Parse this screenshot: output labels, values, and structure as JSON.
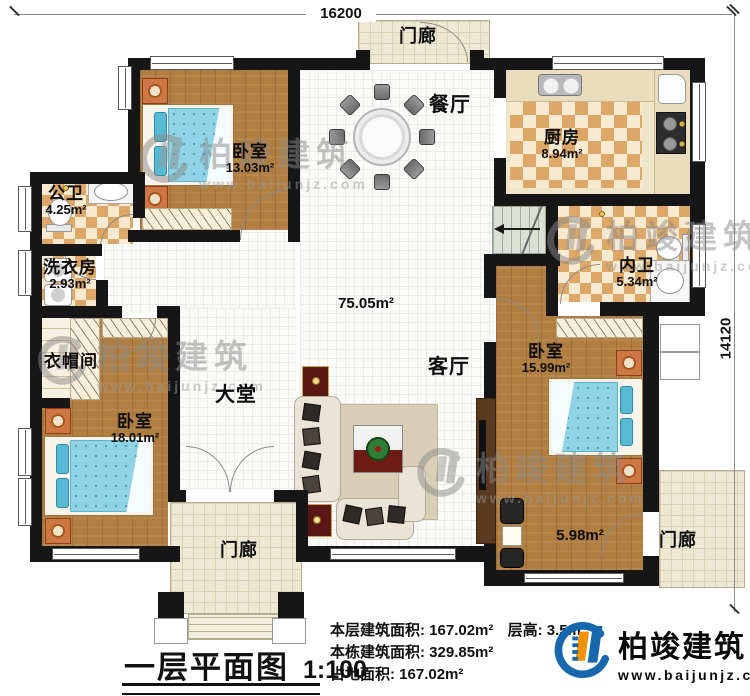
{
  "plan": {
    "dims": {
      "top": "16200",
      "right": "14120"
    },
    "rooms": {
      "bedroom_tl": {
        "name": "卧室",
        "area": "13.03m²"
      },
      "public_bath": {
        "name": "公卫",
        "area": "4.25m²"
      },
      "laundry": {
        "name": "洗衣房",
        "area": "2.93m²"
      },
      "cloakroom": {
        "name": "衣帽间",
        "area": ""
      },
      "bedroom_bl": {
        "name": "卧室",
        "area": "18.01m²"
      },
      "hall": {
        "name": "大堂",
        "area": ""
      },
      "living": {
        "name": "客厅",
        "area": ""
      },
      "dining": {
        "name": "餐厅",
        "area": ""
      },
      "kitchen": {
        "name": "厨房",
        "area": "8.94m²"
      },
      "inner_bath": {
        "name": "内卫",
        "area": "5.34m²"
      },
      "bedroom_r": {
        "name": "卧室",
        "area": "15.99m²"
      },
      "central_area": "75.05m²",
      "side_area": "5.98m²",
      "porch": {
        "name": "门廊"
      }
    }
  },
  "watermark": {
    "text": "柏竣建筑",
    "url": "www.baijunjz.com"
  },
  "footer": {
    "title": "一层平面图",
    "scale": "1:100",
    "stats": [
      [
        "本层建筑面积:",
        "167.02m²",
        "层高:",
        "3.5m"
      ],
      [
        "本栋建筑面积:",
        "329.85m²",
        "",
        ""
      ],
      [
        "占地面积:",
        "167.02m²",
        "",
        ""
      ]
    ],
    "logo": {
      "name": "柏竣建筑",
      "url": "www.baijunjz.com"
    }
  }
}
